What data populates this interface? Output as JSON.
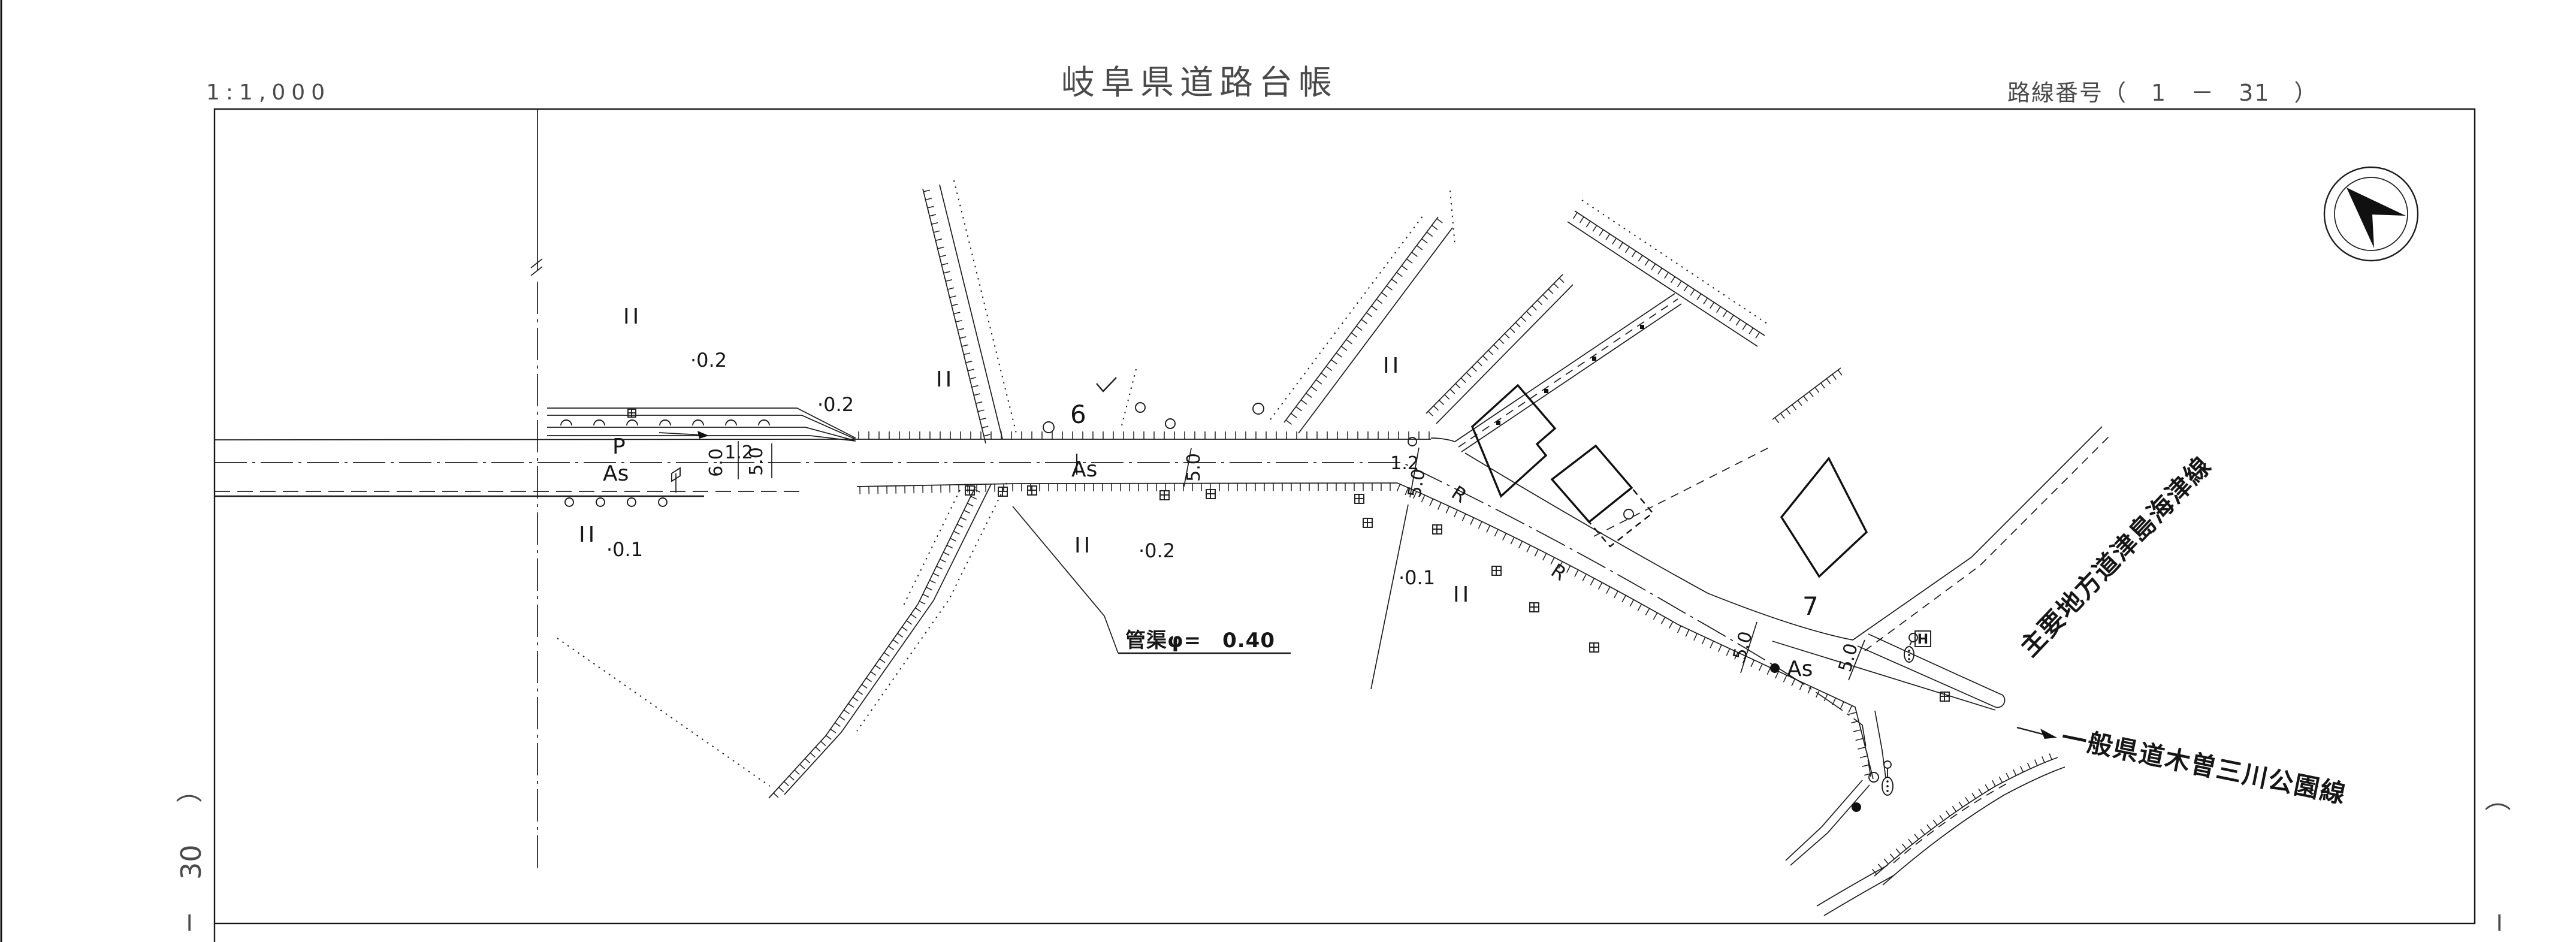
{
  "header": {
    "scale": "1:1,000",
    "title": "岐阜県道路台帳",
    "route_label": "路線番号（　1　－　31　）"
  },
  "margins": {
    "left_paren": "）",
    "left_number": "30",
    "left_dash": "−",
    "right_paren": "（",
    "right_dash": "−"
  },
  "labels": {
    "surface_as": "As",
    "parking_p": "P",
    "curve_r": "R",
    "hydrant_h": "H",
    "station_6": "6",
    "station_7": "7",
    "landuse_ii": "II",
    "offset_02": "·0.2",
    "offset_01": "·0.1",
    "dim_60": "6.0",
    "dim_12": "1.2",
    "dim_50": "5.0"
  },
  "annotations": {
    "culvert": "管渠φ=　0.40",
    "road_general": "一般県道木曽三川公園線",
    "road_major": "主要地方道津島海津線"
  }
}
